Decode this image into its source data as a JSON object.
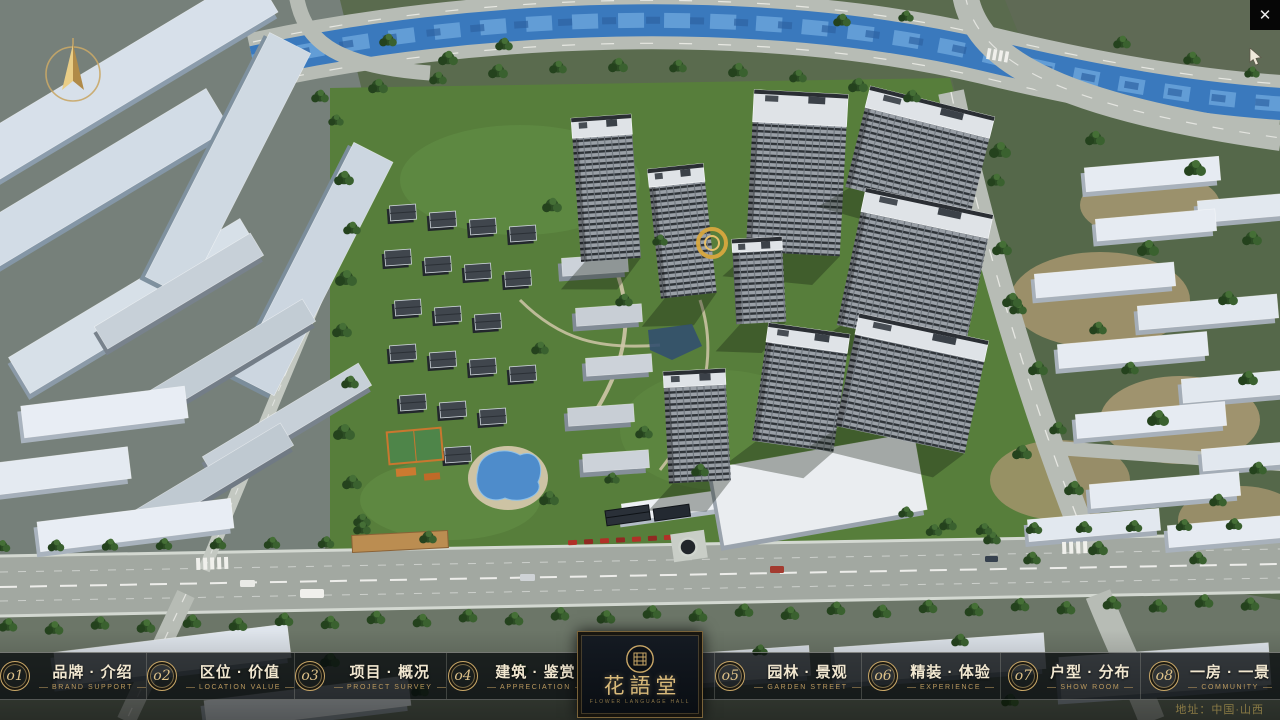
{
  "window": {
    "close_glyph": "✕"
  },
  "nav": {
    "items": [
      {
        "num": "o1",
        "zh": "品牌 · 介绍",
        "en": "BRAND SUPPORT"
      },
      {
        "num": "o2",
        "zh": "区位 · 价值",
        "en": "LOCATION VALUE"
      },
      {
        "num": "o3",
        "zh": "项目 · 概况",
        "en": "PROJECT SURVEY"
      },
      {
        "num": "o4",
        "zh": "建筑 · 鉴赏",
        "en": "APPRECIATION"
      },
      {
        "num": "o5",
        "zh": "园林 · 景观",
        "en": "GARDEN STREET"
      },
      {
        "num": "o6",
        "zh": "精装 · 体验",
        "en": "EXPERIENCE"
      },
      {
        "num": "o7",
        "zh": "户型 · 分布",
        "en": "SHOW ROOM"
      },
      {
        "num": "o8",
        "zh": "一房 · 一景",
        "en": "COMMUNITY"
      }
    ]
  },
  "logo": {
    "title": "花語堂",
    "subtitle": "FLOWER LANGUAGE HALL"
  },
  "footer": {
    "address": "地址：中国·山西"
  },
  "colors": {
    "gold": "#c9a767",
    "gold_dim": "#8d7748",
    "bar_bg": "rgba(8,11,14,0.78)",
    "text_warm": "#f1e7d0"
  }
}
